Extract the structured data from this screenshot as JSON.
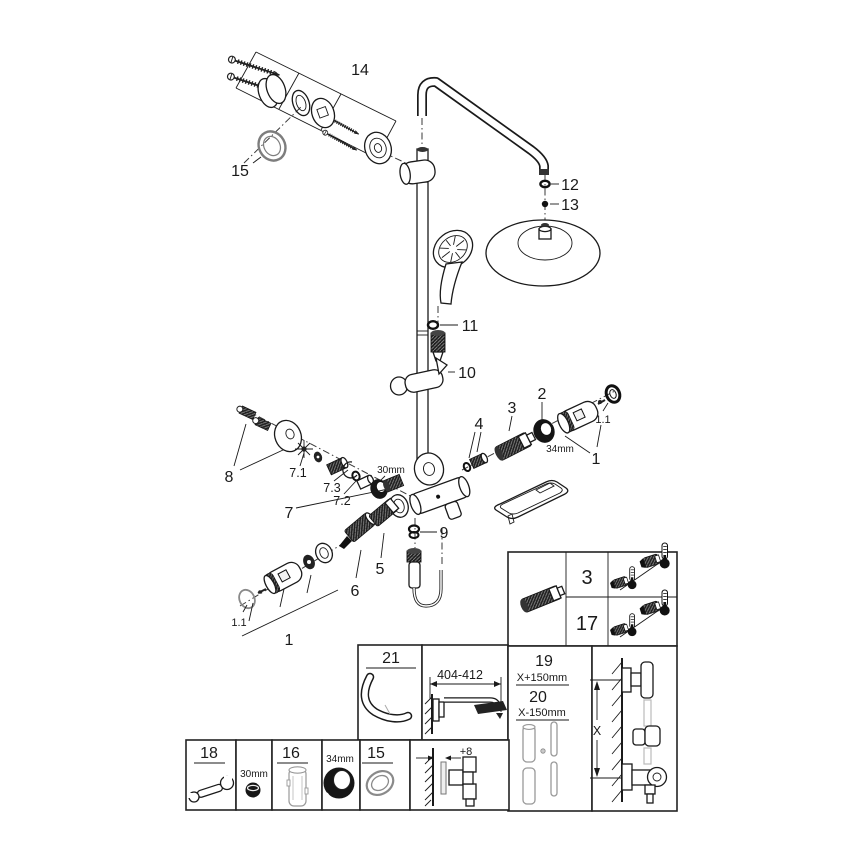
{
  "figure": {
    "background": "#ffffff",
    "line_color": "#1a1a1a"
  },
  "callouts": {
    "bracket": "14",
    "escutcheon": "15",
    "arm_washer": "12",
    "arm_filter": "13",
    "hand_shower_washer": "11",
    "glider": "10",
    "adapter": "4",
    "check_valve": "3",
    "union_nut": "2",
    "nut_size": "34mm",
    "coupling": "1",
    "coupling_seal": "1.1",
    "carrier": "8",
    "knob_group": "7",
    "knob_star": "7.1",
    "knob_ring": "7.2",
    "knob_bush": "7.3",
    "cap_size": "30mm",
    "hose_washer": "9",
    "aquadimmer": "5",
    "thermo_cartridge": "6",
    "coupling_b": "1",
    "coupling_b_seal": "1.1"
  },
  "spec_table": {
    "rows": [
      "3",
      "17"
    ]
  },
  "panels": {
    "arm_part": "21",
    "arm_reach": "404-412",
    "height_upper": "19",
    "height_upper_offset": "X+150mm",
    "height_lower": "20",
    "height_lower_offset": "X-150mm",
    "wall_dim": "X",
    "wrench": "18",
    "plug_size": "30mm",
    "tool": "16",
    "ring_nut_size": "34mm",
    "ring": "15",
    "protrusion": "+8"
  }
}
